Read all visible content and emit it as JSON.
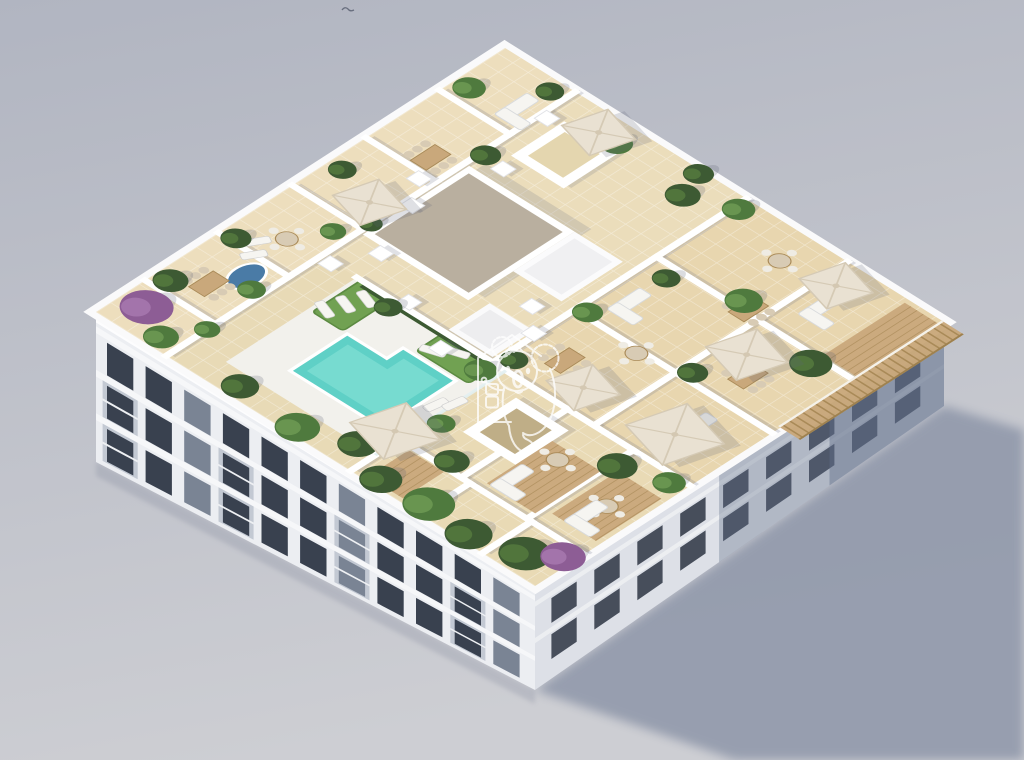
{
  "scene": {
    "title": "aerial-3d-render-apartment-building-rooftop-pool-terrace",
    "background": {
      "top": "#b1b5c1",
      "bottom": "#cdced3"
    },
    "ground_shadow": "#8e96a9",
    "bird": {
      "color": "#686e7e"
    },
    "watermark": {
      "name": "koala-house-logo",
      "color": "#ffffff",
      "opacity": 0.78
    },
    "building": {
      "facade_light": "#eceef2",
      "facade_side": "#dde0e7",
      "facade_shadow": "#5f6d88",
      "slab_band": "#f6f7f9",
      "cornice": "#fdfdfe",
      "window_dark": "#39414f",
      "window_mid": "#7a8494"
    },
    "rooftop": {
      "tile": "#e8dab6",
      "wall": "#ffffff",
      "deck_white": "#f2f1ec",
      "lawn": "#71a152",
      "lawn_dark": "#5c8a42",
      "pool_water": "#5fd0c6",
      "pool_water_light": "#8ae4d9",
      "gravel": "#b9af9f",
      "wood": "#c9a87b",
      "wood_dark": "#a98a58",
      "umbrella": "#e9e1d2",
      "umbrella_shade": "#d5cab5",
      "plant_dark": "#3d5a33",
      "plant_mid": "#4f7a3e",
      "plant_light": "#6f9c55",
      "plant_purple": "#8d5d95",
      "spa_blue": "#4a7ba6",
      "furniture_white": "#f6f5f1",
      "furniture_tan": "#d8cbb4",
      "layout": {
        "tints": [
          [
            0,
            0,
            100,
            16,
            "#f0e2c2",
            0.55
          ],
          [
            38,
            16,
            62,
            39,
            "#eee0bf",
            0.5
          ],
          [
            38,
            55,
            62,
            45,
            "#e7d4aa",
            0.55
          ],
          [
            0,
            58,
            38,
            42,
            "#ead9b3",
            0.45
          ]
        ],
        "walls": [
          [
            0,
            16,
            100,
            16
          ],
          [
            12,
            0,
            12,
            16
          ],
          [
            30,
            0,
            30,
            16
          ],
          [
            48,
            0,
            48,
            16
          ],
          [
            66,
            0,
            66,
            16
          ],
          [
            84,
            0,
            84,
            16
          ],
          [
            38,
            24,
            38,
            100
          ],
          [
            38,
            55,
            100,
            55
          ],
          [
            38,
            78,
            100,
            78
          ],
          [
            58,
            55,
            58,
            100
          ],
          [
            78,
            55,
            78,
            100
          ],
          [
            12,
            58,
            12,
            100
          ],
          [
            12,
            72,
            38,
            72
          ],
          [
            12,
            87,
            38,
            87
          ],
          [
            0,
            74,
            12,
            74
          ],
          [
            0,
            88,
            12,
            88
          ],
          [
            0,
            58,
            12,
            58
          ]
        ],
        "lawns": [
          [
            26,
            25,
            12,
            7
          ],
          [
            31,
            44,
            7,
            12
          ]
        ],
        "skylights": [
          [
            80,
            20,
            13,
            12,
            "light"
          ],
          [
            21,
            64,
            13,
            12,
            "dark"
          ]
        ],
        "chimneys": [
          [
            44,
            21
          ],
          [
            38,
            33
          ],
          [
            33,
            45
          ],
          [
            52,
            48
          ],
          [
            75,
            20
          ],
          [
            63,
            12
          ],
          [
            36,
            17
          ],
          [
            47,
            53
          ],
          [
            90,
            16
          ],
          [
            57,
            16
          ]
        ],
        "decks": [
          [
            14,
            76,
            16,
            11
          ],
          [
            16,
            89,
            16,
            10
          ],
          [
            79,
            92,
            20,
            8
          ],
          [
            1,
            61,
            10,
            8
          ]
        ],
        "tables": [
          [
            19,
            8
          ],
          [
            47,
            63
          ],
          [
            79,
            75
          ],
          [
            66,
            87
          ],
          [
            70,
            11
          ]
        ],
        "roundTables": [
          [
            37,
            9
          ],
          [
            57,
            70
          ],
          [
            24,
            94
          ],
          [
            92,
            70
          ],
          [
            27,
            80
          ]
        ],
        "sofas": [
          [
            66,
            60
          ],
          [
            88,
            83
          ],
          [
            90,
            12
          ],
          [
            50,
            90
          ],
          [
            18,
            78
          ],
          [
            20,
            93
          ]
        ],
        "loungers": [
          [
            28,
            26,
            20
          ],
          [
            31.5,
            27.5,
            20
          ],
          [
            35,
            29,
            20
          ],
          [
            33,
            46,
            160
          ],
          [
            35.5,
            49,
            160
          ],
          [
            23,
            56,
            100
          ],
          [
            25.5,
            58,
            100
          ],
          [
            33,
            6,
            120
          ],
          [
            30,
            8,
            120
          ]
        ],
        "umbrellas": [
          [
            13,
            56,
            11
          ],
          [
            54,
            12,
            9
          ],
          [
            95,
            26,
            9
          ],
          [
            44,
            70,
            9
          ],
          [
            70,
            83,
            10
          ],
          [
            94,
            81,
            9
          ],
          [
            46,
            89,
            12
          ]
        ],
        "plants": [
          [
            7,
            5,
            4.5,
            "p"
          ],
          [
            3,
            12,
            3,
            "m"
          ],
          [
            15,
            3,
            3,
            "d"
          ],
          [
            23,
            14,
            2.4,
            "m"
          ],
          [
            31,
            3,
            2.6,
            "d"
          ],
          [
            44,
            13,
            2.2,
            "m"
          ],
          [
            57,
            3,
            2.4,
            "d"
          ],
          [
            88,
            3,
            2.8,
            "m"
          ],
          [
            97,
            13,
            2.4,
            "d"
          ],
          [
            77,
            17,
            2.6,
            "d"
          ],
          [
            95,
            30,
            2.8,
            "m"
          ],
          [
            99,
            45,
            2.6,
            "d"
          ],
          [
            3,
            30,
            3.2,
            "d"
          ],
          [
            2,
            44,
            3.8,
            "m"
          ],
          [
            6,
            54,
            3.4,
            "d"
          ],
          [
            36,
            33,
            2.4,
            "d"
          ],
          [
            35,
            55,
            2.8,
            "m"
          ],
          [
            41,
            57,
            2.4,
            "d"
          ],
          [
            59,
            57,
            2.6,
            "m"
          ],
          [
            75,
            60,
            2.4,
            "d"
          ],
          [
            80,
            73,
            3.2,
            "m"
          ],
          [
            60,
            80,
            2.6,
            "d"
          ],
          [
            76,
            92,
            3.6,
            "d"
          ],
          [
            97,
            56,
            2.8,
            "m"
          ],
          [
            93,
            47,
            3,
            "d"
          ],
          [
            2,
            63,
            3.6,
            "d"
          ],
          [
            3,
            73,
            4.4,
            "m"
          ],
          [
            2,
            83,
            4,
            "d"
          ],
          [
            5,
            93,
            4.4,
            "d"
          ],
          [
            9,
            98,
            3.8,
            "p"
          ],
          [
            14,
            68,
            3,
            "d"
          ],
          [
            33,
            88,
            3.4,
            "d"
          ],
          [
            36,
            97,
            2.8,
            "m"
          ],
          [
            20,
            60,
            2.4,
            "m"
          ],
          [
            10,
            16,
            2.2,
            "m"
          ],
          [
            50,
            16,
            2,
            "d"
          ]
        ]
      }
    }
  }
}
